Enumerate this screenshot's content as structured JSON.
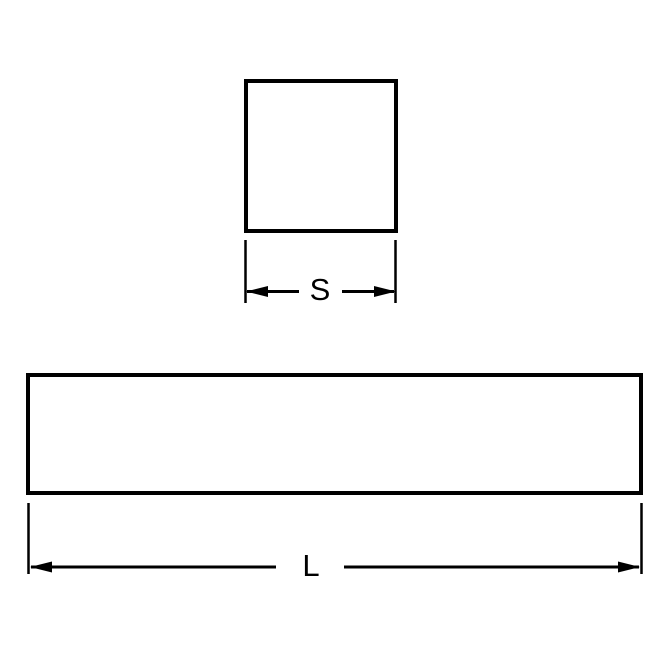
{
  "diagram": {
    "square_width_label": "S",
    "bar_length_label": "L",
    "colors": {
      "line": "#000000",
      "background": "#ffffff"
    }
  }
}
